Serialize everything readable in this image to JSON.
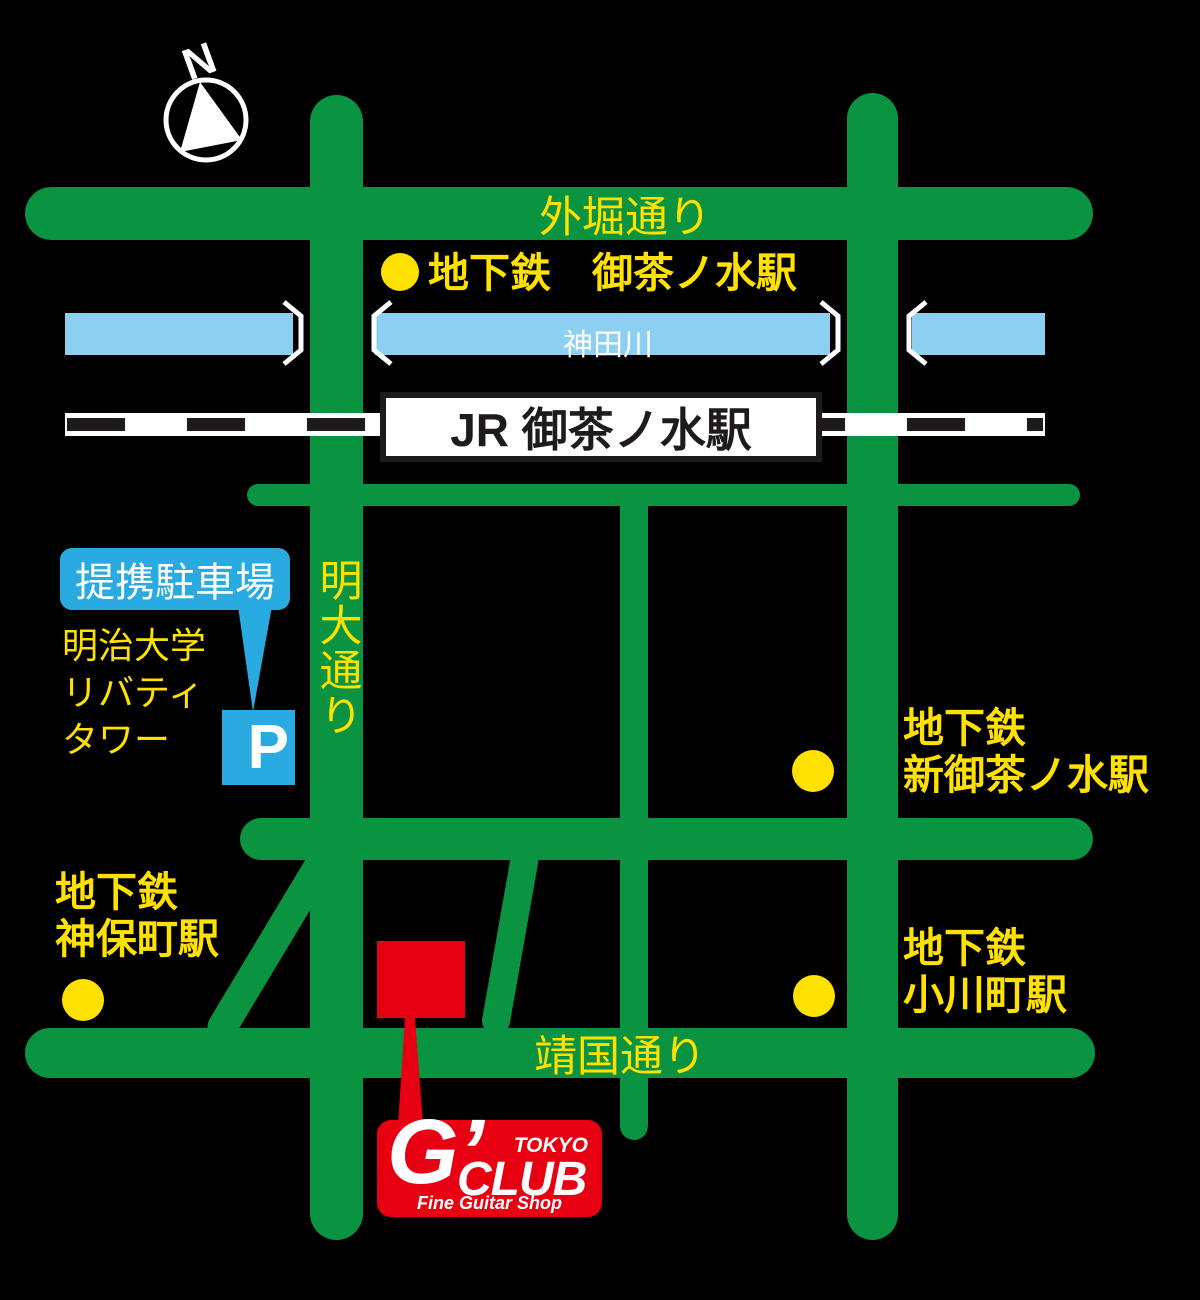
{
  "compass": {
    "label": "N"
  },
  "roads": {
    "sotobori_dori": "外堀通り",
    "meidai_dori": "明大通り",
    "yasukuni_dori": "靖国通り"
  },
  "river": {
    "name": "神田川"
  },
  "jr_station": {
    "name": "JR 御茶ノ水駅"
  },
  "stations": {
    "metro_ochanomizu": {
      "label": "地下鉄　御茶ノ水駅"
    },
    "metro_shin_ochanomizu": {
      "line1": "地下鉄",
      "line2": "新御茶ノ水駅"
    },
    "metro_jimbocho": {
      "line1": "地下鉄",
      "line2": "神保町駅"
    },
    "metro_ogawamachi": {
      "line1": "地下鉄",
      "line2": "小川町駅"
    }
  },
  "parking": {
    "label": "提携駐車場",
    "building_line1": "明治大学",
    "building_line2": "リバティ",
    "building_line3": "タワー",
    "symbol": "P"
  },
  "shop": {
    "brand_g": "G’",
    "brand_club": "CLUB",
    "brand_tokyo": "TOKYO",
    "tagline": "Fine Guitar Shop"
  },
  "colors": {
    "background": "#000000",
    "road_green": "#0a9442",
    "label_yellow": "#ffe100",
    "river_blue": "#8ccff0",
    "parking_blue": "#29abe2",
    "brand_red": "#e60012",
    "railway_dash": "#1f1b1c"
  }
}
